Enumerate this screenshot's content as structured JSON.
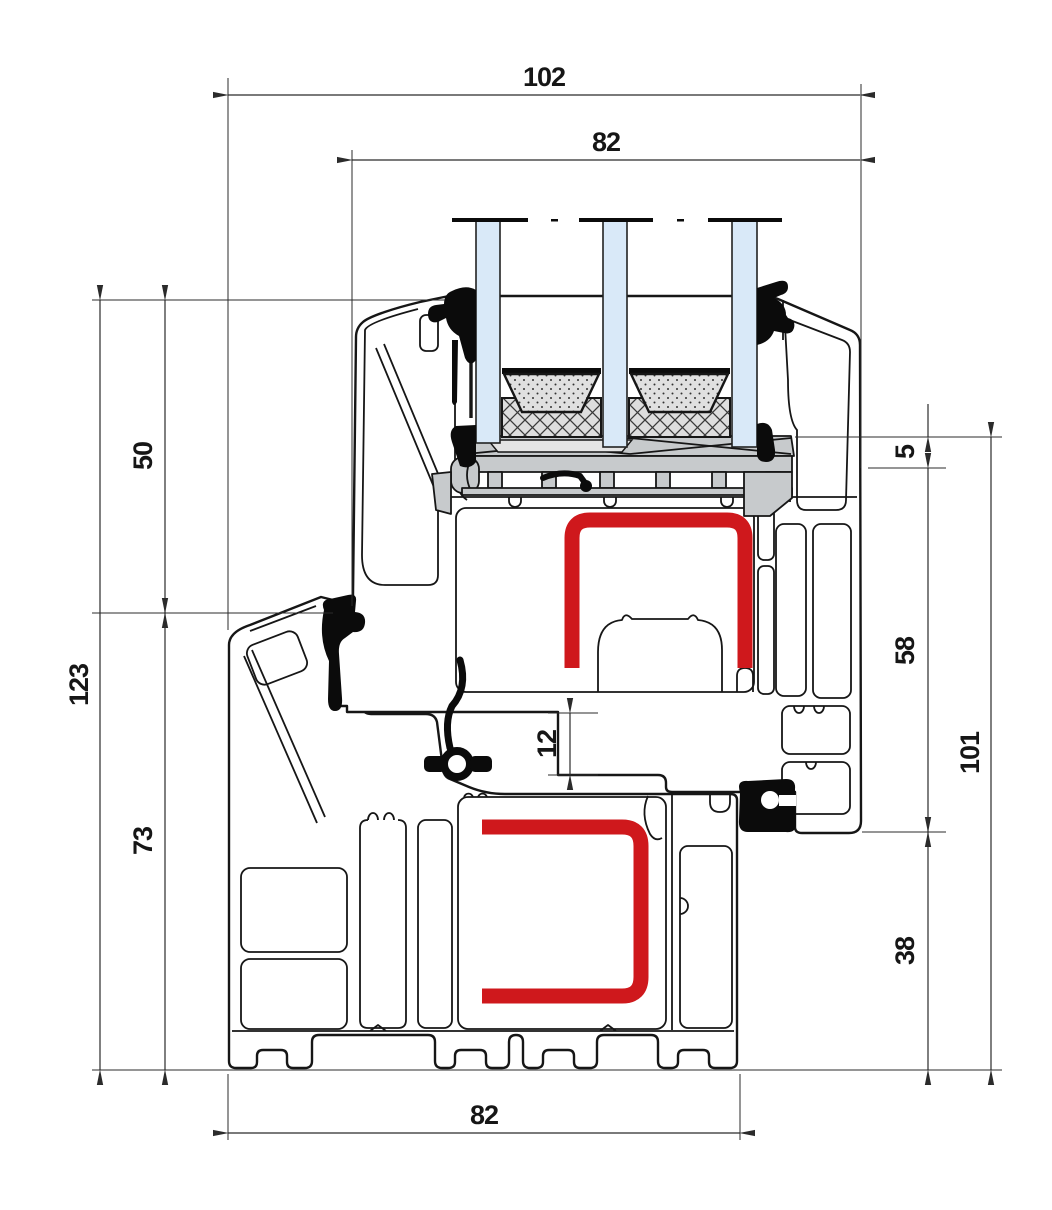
{
  "drawing": {
    "title": "Window frame profile cross-section",
    "dimensions": {
      "overall_width": "102",
      "glazing_width": "82",
      "upper_height": "50",
      "total_height": "123",
      "frame_height": "73",
      "glass_recess": "5",
      "sash_face_height": "58",
      "overall_height_right": "101",
      "lower_height": "38",
      "overlap": "12",
      "frame_width": "82"
    },
    "colors": {
      "reinforcement": "#cf181c",
      "glass": "#d9e9f8",
      "hardware": "#c7cacc",
      "outline": "#161616"
    }
  }
}
